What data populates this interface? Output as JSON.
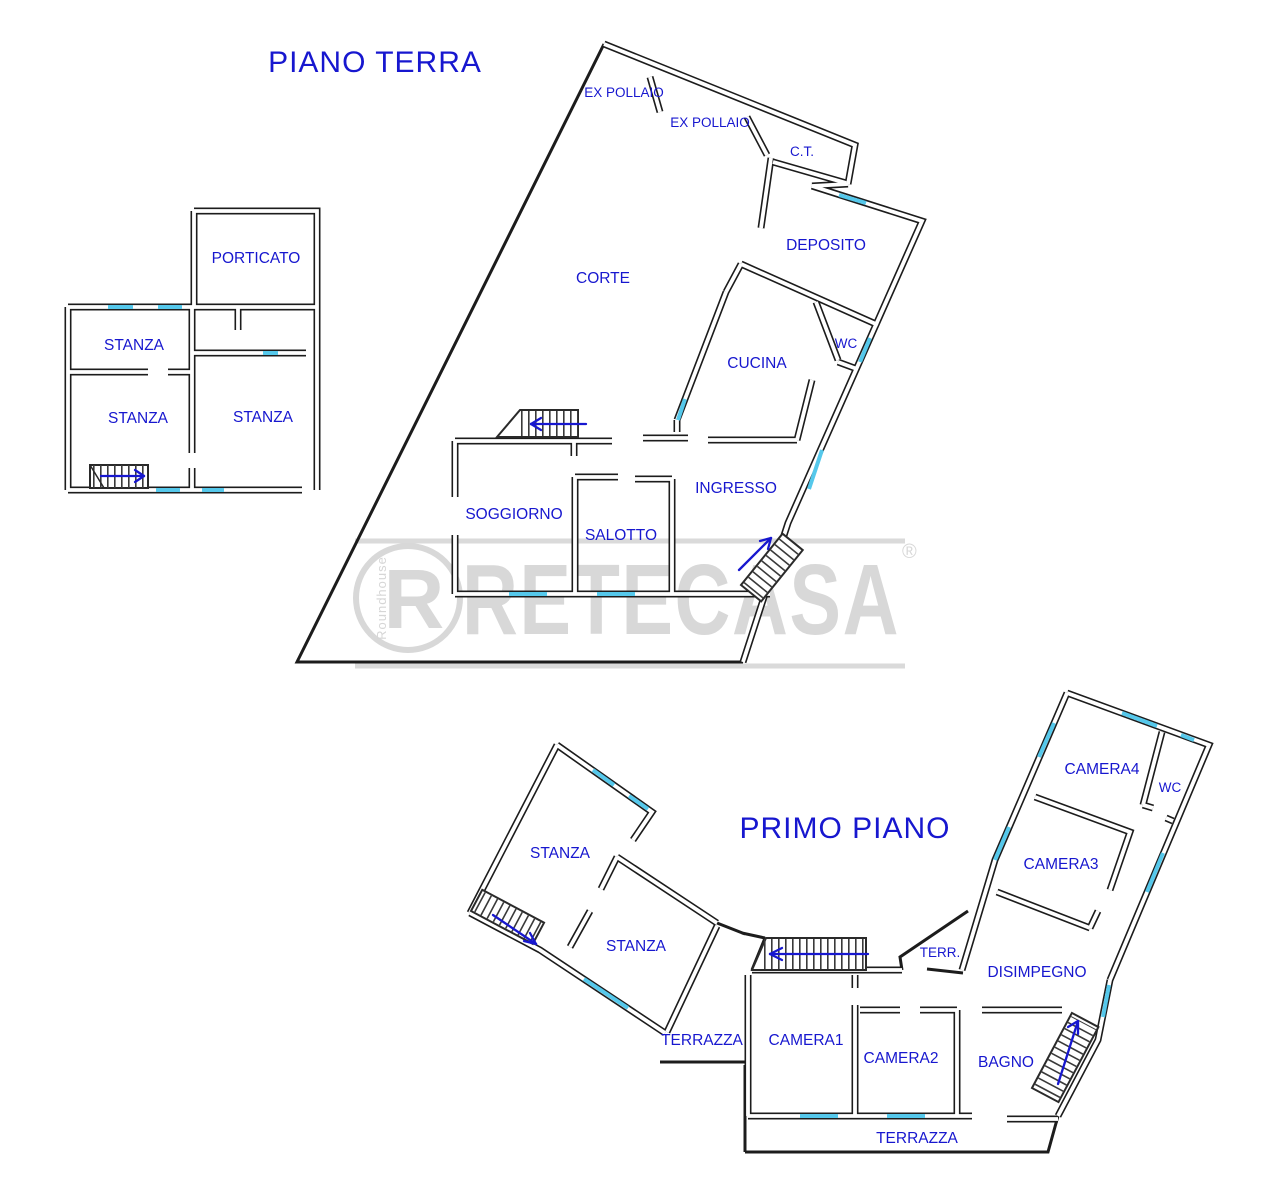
{
  "titles": {
    "ground": "PIANO TERRA",
    "first": "PRIMO PIANO"
  },
  "ground_annex": {
    "porticato": "PORTICATO",
    "stanza_a": "STANZA",
    "stanza_b": "STANZA",
    "stanza_c": "STANZA"
  },
  "ground_main": {
    "ex_pollaio_a": "EX POLLAIO",
    "ex_pollaio_b": "EX POLLAIO",
    "ct": "C.T.",
    "deposito": "DEPOSITO",
    "corte": "CORTE",
    "cucina": "CUCINA",
    "wc": "WC",
    "ingresso": "INGRESSO",
    "soggiorno": "SOGGIORNO",
    "salotto": "SALOTTO"
  },
  "first_floor": {
    "stanza_a": "STANZA",
    "stanza_b": "STANZA",
    "terrazza_left": "TERRAZZA",
    "camera1": "CAMERA1",
    "camera2": "CAMERA2",
    "camera3": "CAMERA3",
    "camera4": "CAMERA4",
    "wc": "WC",
    "terr": "TERR.",
    "disimpegno": "DISIMPEGNO",
    "bagno": "BAGNO",
    "terrazza_bottom": "TERRAZZA"
  },
  "watermark": {
    "brand": "RETECASA",
    "registered": "®",
    "logo_letter": "R",
    "logo_side_text": "Roundhouse"
  },
  "colors": {
    "label_blue": "#1717cf",
    "wall_dark": "#1c1c1c",
    "window_blue": "#55c8eb",
    "watermark_gray": "#d8d8d8"
  }
}
